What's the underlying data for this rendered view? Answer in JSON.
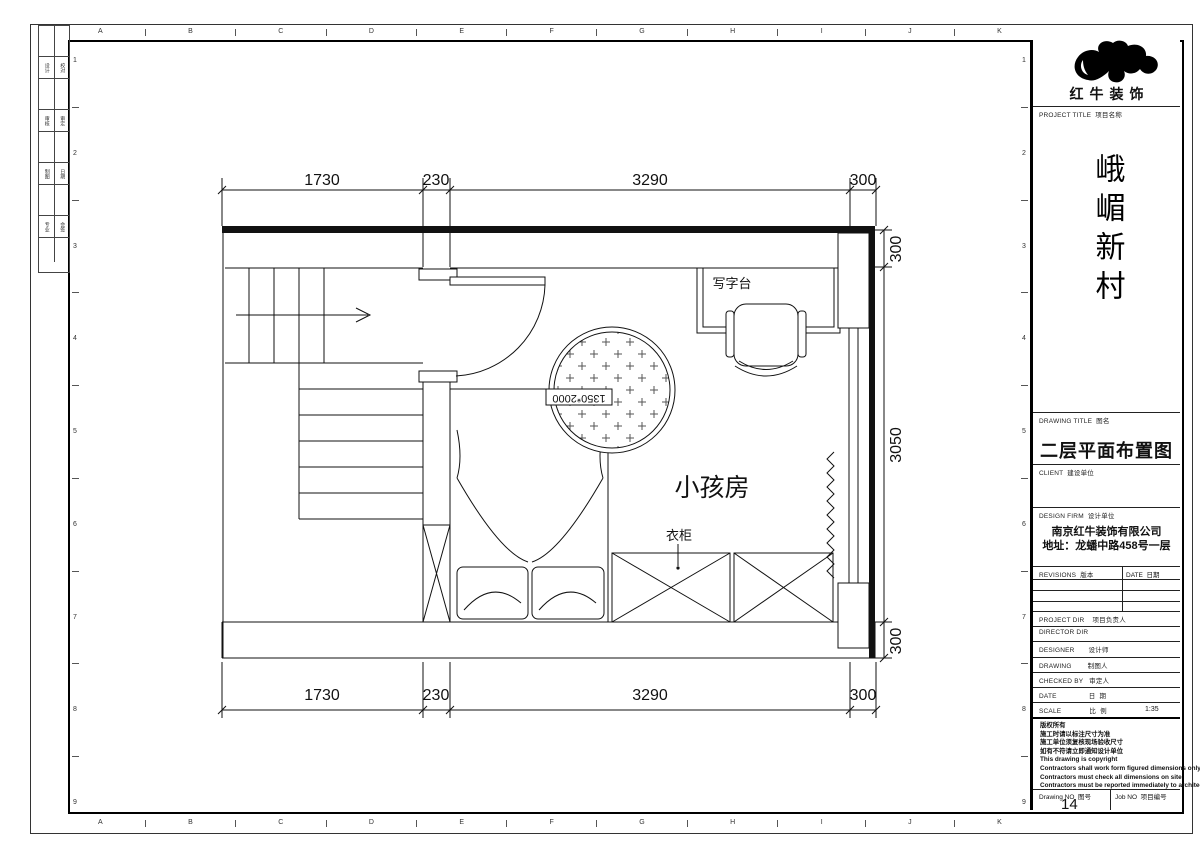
{
  "sheet": {
    "grid_letters": [
      "A",
      "B",
      "C",
      "D",
      "E",
      "F",
      "G",
      "H",
      "I",
      "J",
      "K"
    ],
    "grid_numbers": [
      "1",
      "2",
      "3",
      "4",
      "5",
      "6",
      "7",
      "8",
      "9"
    ],
    "margin_rows": [
      [
        "设计",
        "校对"
      ],
      [
        "审核",
        "审定"
      ],
      [
        "制图",
        "日期"
      ],
      [
        "专业",
        "会签"
      ]
    ]
  },
  "plan": {
    "dims_top": [
      "1730",
      "230",
      "3290",
      "300"
    ],
    "dims_bottom": [
      "1730",
      "230",
      "3290",
      "300"
    ],
    "dims_right": [
      "300",
      "3050",
      "300"
    ],
    "room_label": "小孩房",
    "desk_label": "写字台",
    "wardrobe_label": "衣柜",
    "bed_size_label": "1350*2000"
  },
  "tb": {
    "brand_name": "红牛装饰",
    "project_title_label": "PROJECT TITLE  项目名称",
    "project_name": "峨嵋新村",
    "drawing_title_label": "DRAWING TITLE  图名",
    "drawing_title": "二层平面布置图",
    "client_label": "CLIENT  建设单位",
    "design_firm_label": "DESIGN FIRM  设计单位",
    "firm_name": "南京红牛装饰有限公司",
    "firm_address": "地址：龙蟠中路458号一层",
    "revisions_label": "REVISIONS  版本",
    "rev_date_label": "DATE  日期",
    "rows": [
      "PROJECT DIR    项目负责人",
      "DIRECTOR DIR",
      "DESIGNER       设计师",
      "DRAWING        制图人",
      "CHECKED BY   审定人",
      "DATE                日  期",
      "SCALE              比  例"
    ],
    "scale_value": "1:35",
    "notes": [
      "版权所有",
      "施工时请以标注尺寸为准",
      "施工单位须复核现场验收尺寸",
      "如有不符请立即通知设计单位",
      "This drawing is copyright",
      "Contractors shall work form figured dimensions only",
      "Contractors must check all dimensions on site",
      "Contractors must be reported immediately to architects"
    ],
    "drawing_no_label": "Drawing NO  图号",
    "drawing_no": "14",
    "job_no_label": "Job NO  项目编号"
  }
}
